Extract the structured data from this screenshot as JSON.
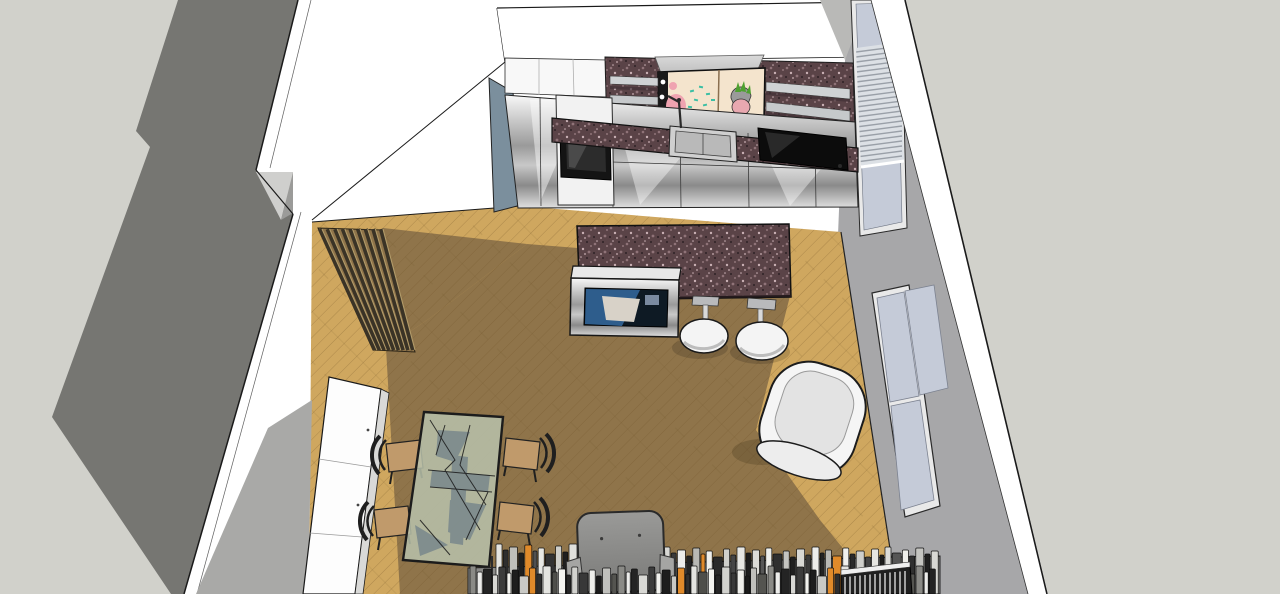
{
  "scene": {
    "description": "3D bird's-eye rendering of an open-plan apartment: linear kitchen, granite island with bar stools, glass dining table, bookshelf wall",
    "view": "perspective top-down orbit view"
  },
  "colors": {
    "background": "#d1d1cb",
    "ground_shadow": "#767672",
    "wall_white": "#ffffff",
    "wall_shadow": "#a9a9a7",
    "wall_corner_light": "#cfcfcd",
    "wall_corner_dark": "#9b9b99",
    "right_wall_face": "#a7a7a9",
    "right_wall_corner": "#b9b9b7",
    "window_frame": "#e9e9e9",
    "window_glass": "#c5cbd8",
    "blinds": "#dce0e5",
    "blind_line": "#9aa0a8",
    "floor_light": "#cfa75f",
    "floor_shadow": "#8f744a",
    "plank_line": "#6d5126",
    "granite_base": "#5a4347",
    "granite_speck_light": "#8f7378",
    "granite_speck_pale": "#c9b0b4",
    "granite_speck_dark": "#2e2125",
    "cabinet_white": "#f8f8f8",
    "oven_black": "#141414",
    "cooktop_black": "#0c0c0c",
    "blue_panel": "#7b8f9d",
    "art_cream": "#f4e4cd",
    "art_pink": "#efa3b0",
    "art_teal": "#3bbfa4",
    "art_green": "#4ea12f",
    "glass_table": "#b9c2ab",
    "glass_shadow": "#5a6f82",
    "chair_frame": "#1f1f1f",
    "chair_seat": "#c09a6b",
    "armchair_white": "#f5f5f5",
    "armchair_inner": "#e3e3e3",
    "lounge_gray": "#8e8e8c",
    "shelf_gray": "#8b8b89",
    "radiator_dark": "#1f1f1f",
    "sideboard_white": "#fdfdfd",
    "stool_white": "#f4f4f4",
    "slat_dark": "#3a3326",
    "slat_highlight": "#b39c6a",
    "book_orange": "#e08a2a",
    "outline": "#1a1a1a"
  },
  "slat_screen": {
    "count": 9
  },
  "bar_stools": {
    "count": 2
  },
  "windows": {
    "right_wall_count": 2,
    "blind_rows": 24
  },
  "radiator": {
    "slat_count": 13
  },
  "dining": {
    "chair_count": 4,
    "chairs": [
      {
        "x": 384,
        "y": 428,
        "flip": false
      },
      {
        "x": 372,
        "y": 494,
        "flip": false
      },
      {
        "x": 542,
        "y": 426,
        "flip": true
      },
      {
        "x": 536,
        "y": 490,
        "flip": true
      }
    ]
  },
  "bookshelf": {
    "rows": [
      {
        "name": "back-left",
        "x": 496,
        "end": 580,
        "top": 544,
        "colors": [
          "#e4e4e0",
          "#2e2e2e",
          "#bfbfba",
          "#1f1f1f",
          "#e08a2a",
          "#505050",
          "#e8e8e4",
          "#333333",
          "#cfcfca",
          "#1f1f1f",
          "#e0e0dc",
          "#4a4a4a"
        ]
      },
      {
        "name": "back-right",
        "x": 664,
        "end": 932,
        "top": 547,
        "colors": [
          "#d8d8d4",
          "#3a3a3a",
          "#ececea",
          "#232323",
          "#b8b8b4",
          "#e08a2a",
          "#f0f0ec",
          "#2a2a2a",
          "#cfcfcb",
          "#454545",
          "#e6e6e2",
          "#1c1c1c",
          "#dcdcd8",
          "#565656",
          "#efefeb",
          "#2f2f2f",
          "#c4c4c0",
          "#1f1f1f"
        ]
      },
      {
        "name": "front",
        "x": 470,
        "end": 936,
        "top": 566,
        "colors": [
          "#8a8a86",
          "#ececea",
          "#242424",
          "#d8d8d4",
          "#3c3c3c",
          "#f2f2ee",
          "#1d1d1d",
          "#c9c9c5",
          "#e08a2a",
          "#2e2e2e",
          "#e4e4e0",
          "#4e4e4a",
          "#f4f4f0",
          "#262626",
          "#d2d2ce",
          "#383838",
          "#eeeeea",
          "#1a1a1a",
          "#c0c0bc",
          "#545450"
        ]
      }
    ]
  }
}
